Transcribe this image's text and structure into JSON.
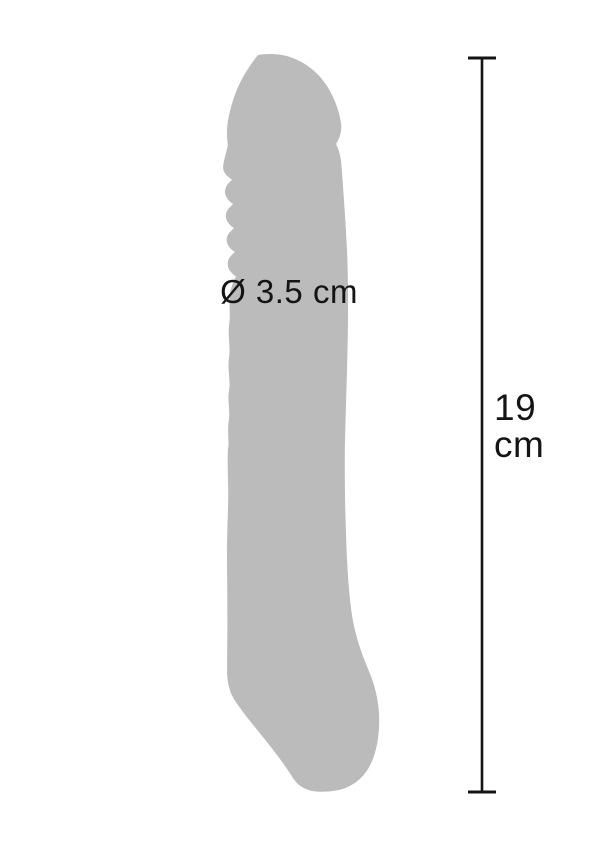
{
  "canvas": {
    "width": 600,
    "height": 850,
    "background": "#ffffff"
  },
  "product": {
    "description": "gray product silhouette",
    "color": "#bbbbbb"
  },
  "annotations": {
    "color": "#141414",
    "diameter_label": "Ø 3.5 cm",
    "length": {
      "value": "19",
      "unit": "cm"
    }
  }
}
